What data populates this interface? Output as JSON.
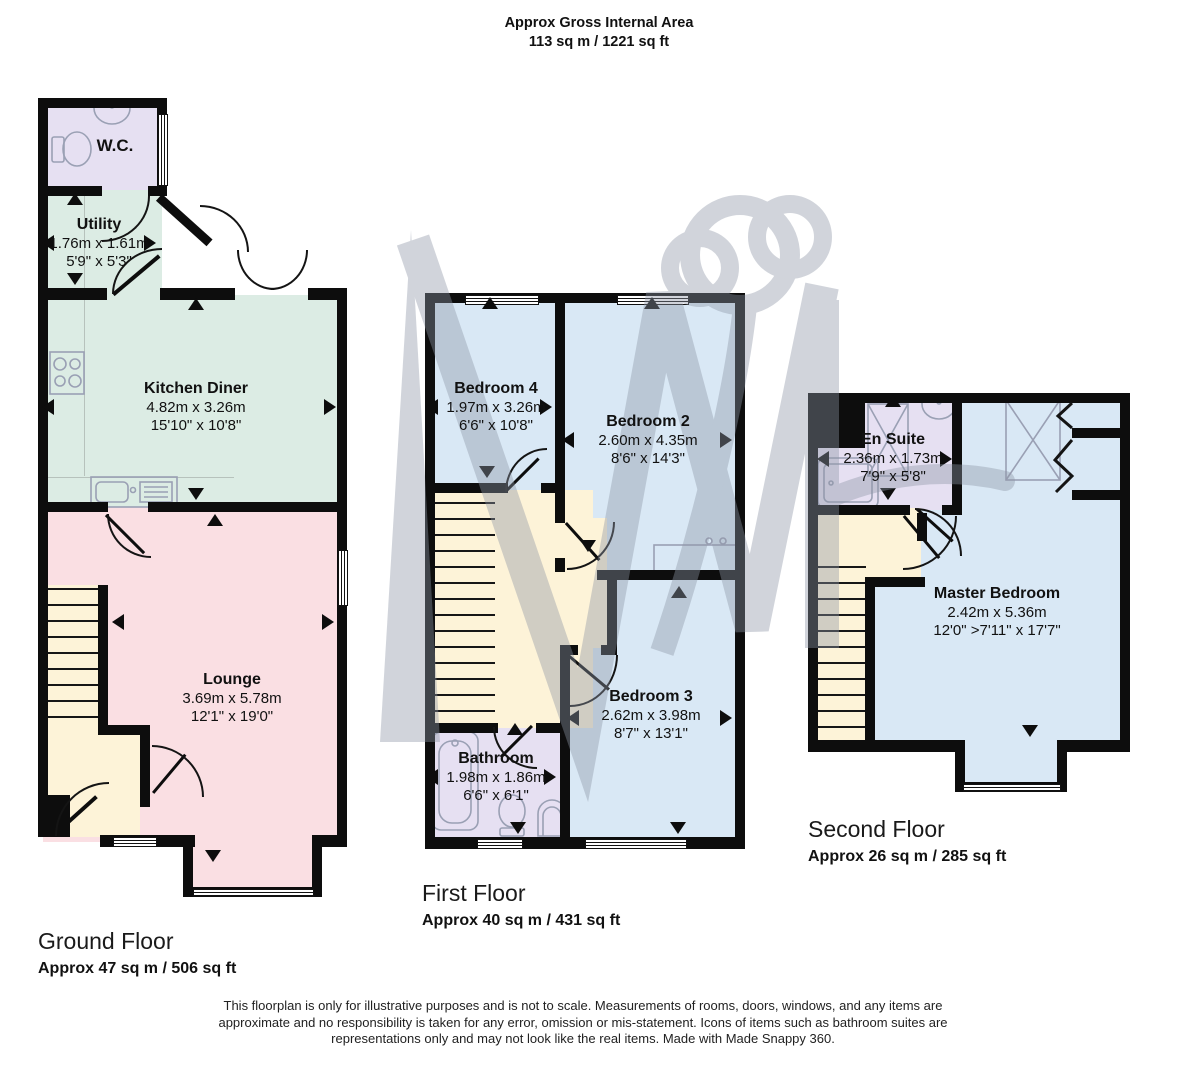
{
  "header": {
    "title": "Approx Gross Internal Area",
    "area": "113 sq m / 1221 sq ft"
  },
  "floors": {
    "ground": {
      "label": "Ground Floor",
      "area": "Approx 47 sq m / 506 sq ft"
    },
    "first": {
      "label": "First Floor",
      "area": "Approx 40 sq m / 431 sq ft"
    },
    "second": {
      "label": "Second Floor",
      "area": "Approx 26 sq m / 285 sq ft"
    }
  },
  "rooms": {
    "wc": {
      "name": "W.C."
    },
    "utility": {
      "name": "Utility",
      "metric": "1.76m x 1.61m",
      "imperial": "5'9\" x 5'3\""
    },
    "kitchen": {
      "name": "Kitchen Diner",
      "metric": "4.82m x 3.26m",
      "imperial": "15'10\" x 10'8\""
    },
    "lounge": {
      "name": "Lounge",
      "metric": "3.69m x 5.78m",
      "imperial": "12'1\" x 19'0\""
    },
    "bedroom4": {
      "name": "Bedroom 4",
      "metric": "1.97m x 3.26m",
      "imperial": "6'6\" x 10'8\""
    },
    "bedroom2": {
      "name": "Bedroom 2",
      "metric": "2.60m x 4.35m",
      "imperial": "8'6\" x 14'3\""
    },
    "bedroom3": {
      "name": "Bedroom 3",
      "metric": "2.62m x 3.98m",
      "imperial": "8'7\" x 13'1\""
    },
    "bathroom": {
      "name": "Bathroom",
      "metric": "1.98m x 1.86m",
      "imperial": "6'6\" x 6'1\""
    },
    "ensuite": {
      "name": "En Suite",
      "metric": "2.36m x 1.73m",
      "imperial": "7'9\" x 5'8\""
    },
    "master": {
      "name": "Master Bedroom",
      "metric": "2.42m x 5.36m",
      "imperial": "12'0\" >7'11\" x 17'7\""
    }
  },
  "footer": {
    "disclaimer": "This floorplan is only for illustrative purposes and is not to scale. Measurements of rooms, doors, windows, and any items are approximate and no responsibility is taken for any error, omission or mis-statement. Icons of items such as bathroom suites are representations only and may not look like the real items. Made with Made Snappy 360."
  },
  "icons": {
    "toilet": "toilet-icon",
    "basin": "basin-icon",
    "hob": "hob-icon",
    "kitchen_sink": "kitchen-sink-icon",
    "bath": "bath-icon",
    "shower": "shower-icon",
    "shower_tray": "shower-tray-icon",
    "wardrobe": "wardrobe-icon",
    "desk": "desk-icon",
    "stairs": "stairs",
    "watermark": "made-snappy-watermark"
  },
  "colors": {
    "wall": "#0d0d0d",
    "bedroom": "#d9e8f5",
    "kitchen": "#dcece4",
    "lounge": "#fadfe3",
    "hall": "#fdf3d8",
    "bathroom": "#e6e0f2",
    "watermark": "#8e96a6"
  }
}
